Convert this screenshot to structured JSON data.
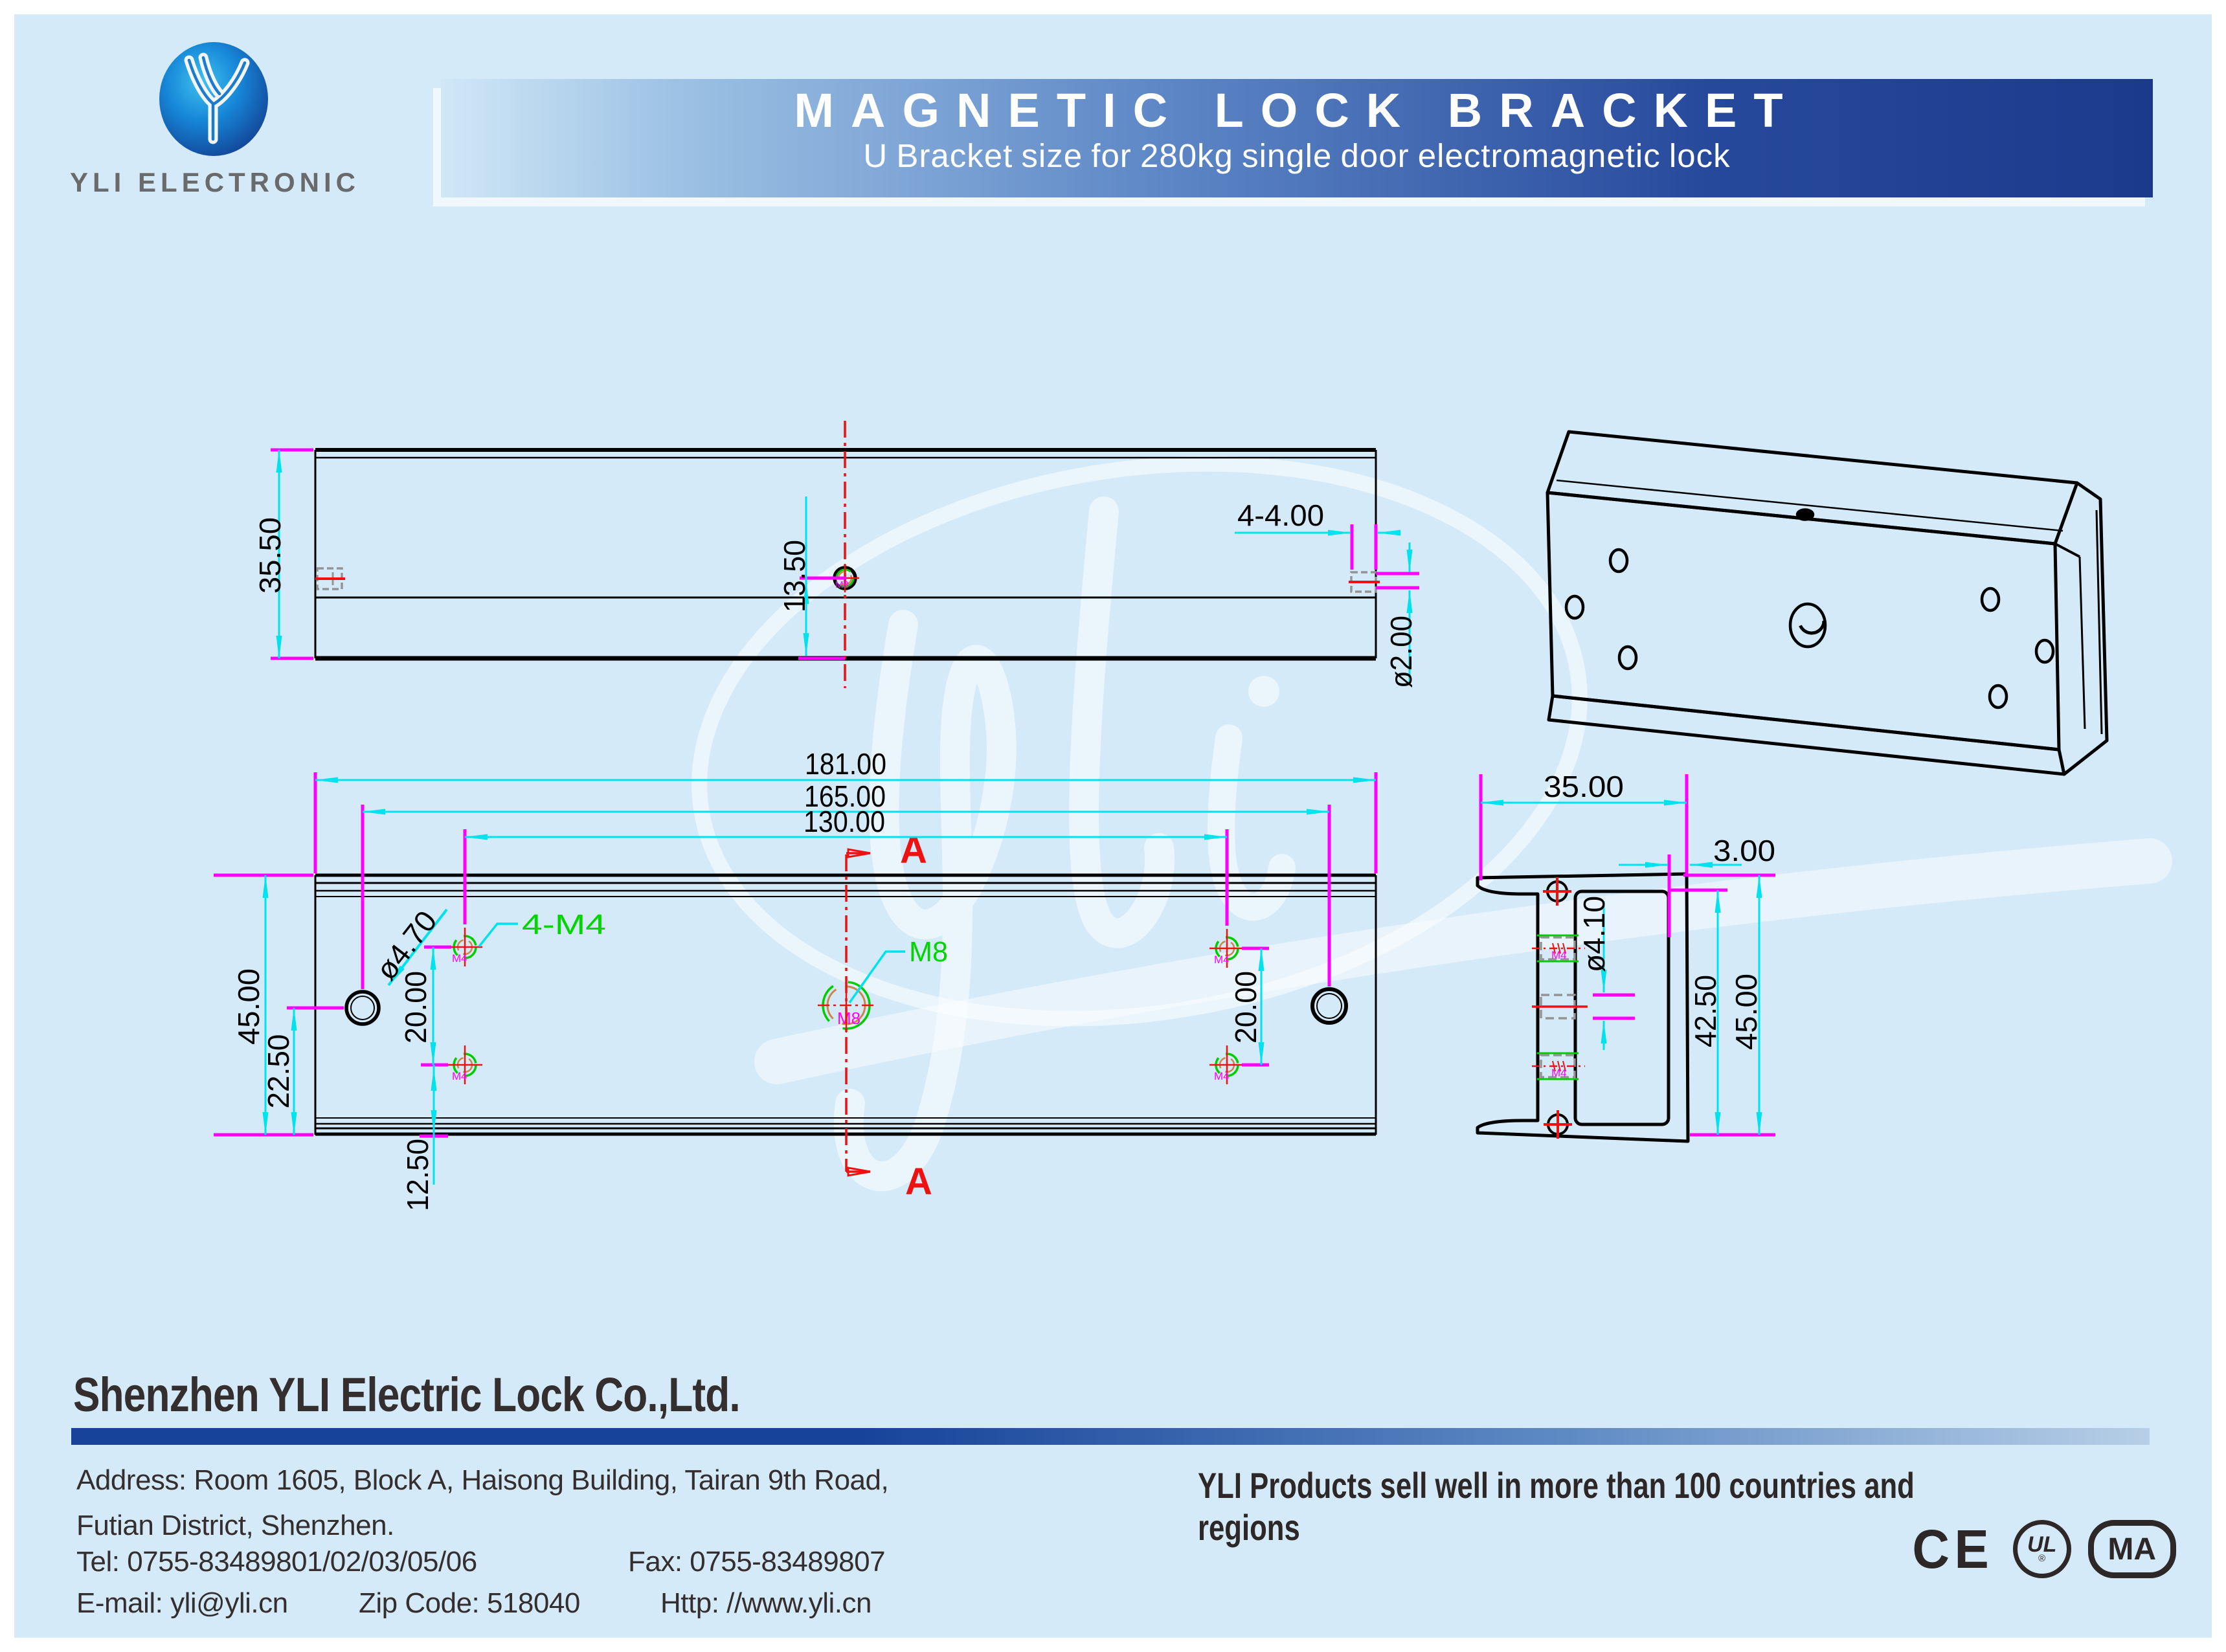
{
  "header": {
    "brand": "YLI ELECTRONIC",
    "title": "MAGNETIC LOCK BRACKET",
    "subtitle": "U Bracket size for 280kg single door electromagnetic lock"
  },
  "drawing": {
    "colors": {
      "line": "#000000",
      "dim": "#00e2ee",
      "ext": "#ff00ff",
      "center": "#ee1111",
      "callout": "#00d500",
      "tan": "#c8884b",
      "gray": "#949494"
    },
    "top_view": {
      "height": "35.50",
      "hole_to_edge": "13.50",
      "end_slot": "4-4.00",
      "end_slot_dia": "ø2.00"
    },
    "front_view": {
      "length": "181.00",
      "hole_span": "165.00",
      "m4_span": "130.00",
      "height": "45.00",
      "center_offset": "22.50",
      "m4_pitch": "20.00",
      "m4_to_edge": "12.50",
      "corner_hole": "ø4.70",
      "m4_callout": "4-M4",
      "m8_callout": "M8",
      "section_letter": "A"
    },
    "side_view": {
      "width": "35.00",
      "wall": "3.00",
      "hole": "ø4.10",
      "inner_height": "42.50",
      "height": "45.00"
    },
    "labels": {
      "m4": "M4",
      "m8": "M8"
    }
  },
  "footer": {
    "company": "Shenzhen YLI Electric Lock Co.,Ltd.",
    "address_line1": "Address: Room 1605, Block A, Haisong Building, Tairan 9th Road,",
    "address_line2": "Futian District, Shenzhen.",
    "tel": "Tel: 0755-83489801/02/03/05/06",
    "fax": "Fax: 0755-83489807",
    "email": "E-mail: yli@yli.cn",
    "zip": "Zip Code: 518040",
    "web": "Http: //www.yli.cn",
    "tagline": "YLI Products sell well in more than 100 countries and regions",
    "certs": [
      {
        "id": "ce",
        "label": "CE"
      },
      {
        "id": "ul",
        "label": "UL",
        "reg": "®"
      },
      {
        "id": "cma",
        "label": "MA"
      }
    ]
  }
}
